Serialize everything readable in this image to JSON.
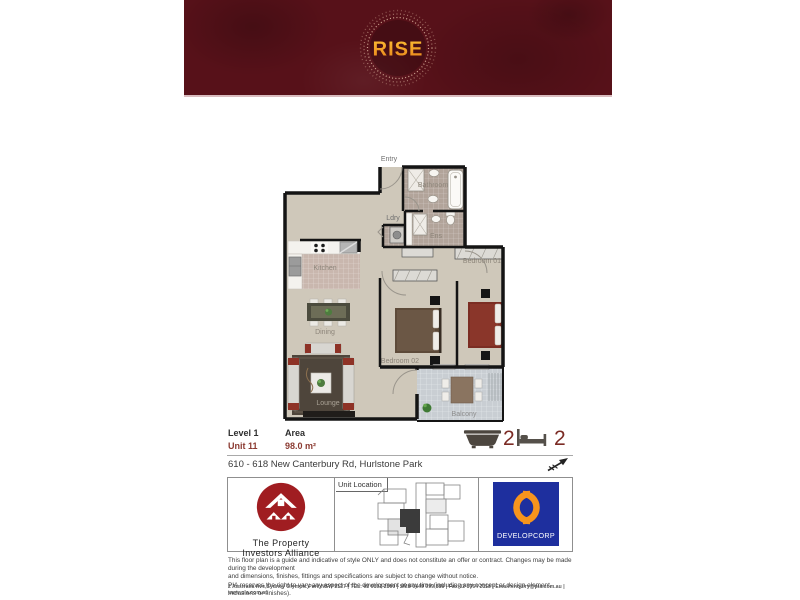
{
  "banner": {
    "title": "RISE"
  },
  "floorplan": {
    "labels": {
      "entry": "Entry",
      "bathroom": "Bathroom",
      "laundry": "Ldry",
      "ensuite": "Ens",
      "kitchen": "Kitchen",
      "bedroom1": "Bedroom 01",
      "bedroom2": "Bedroom 02",
      "dining": "Dining",
      "lounge": "Lounge",
      "balcony": "Balcony"
    }
  },
  "unit_info": {
    "level": "Level 1",
    "unit": "Unit 11",
    "area_label": "Area",
    "area_value": "98.0 m²",
    "bathrooms": "2",
    "bedrooms": "2"
  },
  "address": "610 - 618 New Canterbury Rd, Hurlstone Park",
  "branding": {
    "pia_name_line1": "The Property",
    "pia_name_line2": "Investors Alliance",
    "unit_location_label": "Unit Location",
    "developer_name": "DEVELOPCORP"
  },
  "legal": {
    "disclaimer_line1": "This floor plan is a guide and indicative of style ONLY and does not constitute an offer or contract. Changes may be made during the development",
    "disclaimer_line2": "and dimensions, finishes, fittings and specifications are subject to change without notice.",
    "disclaimer_line3": "PIA reserves the right to vary any aspect of the development at any time (including any concept or design element, inclusions or finishes).",
    "contact_line": "2 Australia Ave,Sydney Olympic Park,NSW 2127  |  TEL: 02 9192 2800  |  SMS 0449 999 888  |  Fax:02 8764 2118  |  Email:enquiry@pia.com.au  |  www.pia.com.au"
  },
  "colors": {
    "banner_bg": "#571119",
    "logo_gold": "#f5a01f",
    "accent_red": "#8b3a31",
    "developer_blue": "#1e2f9e",
    "developer_orange": "#f7941d"
  }
}
